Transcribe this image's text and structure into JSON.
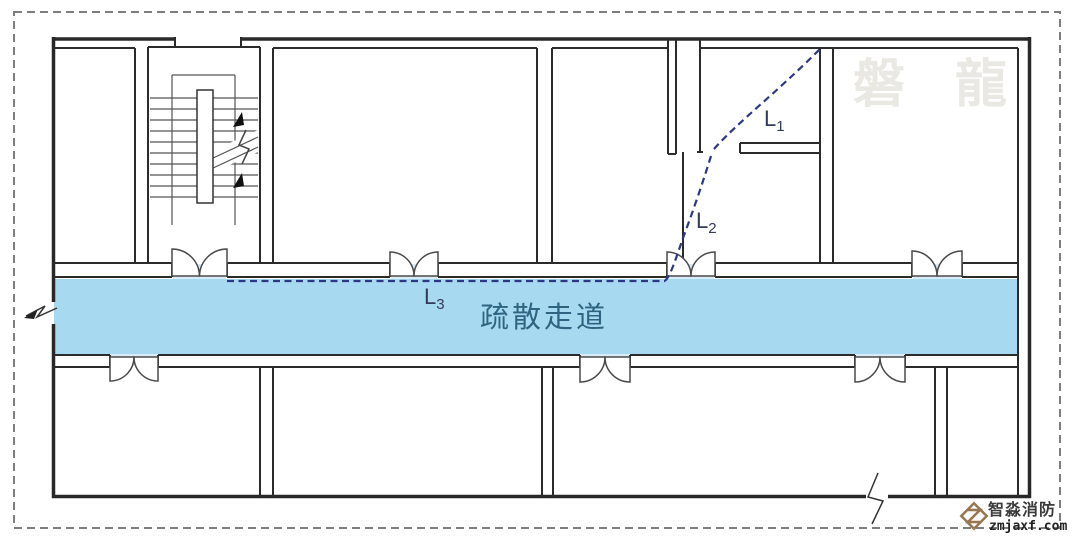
{
  "diagram": {
    "type": "evacuation-floor-plan",
    "corridor": {
      "label": "疏散走道",
      "fill_color": "#a7d9f1",
      "label_color": "#2e647f"
    },
    "path_labels": {
      "l1": {
        "base": "L",
        "sub": "1"
      },
      "l2": {
        "base": "L",
        "sub": "2"
      },
      "l3": {
        "base": "L",
        "sub": "3"
      }
    },
    "escape_path": {
      "color": "#2c3884",
      "style": "dashed"
    },
    "watermark": {
      "text": "磐 龍",
      "color": "#e9e8e3"
    },
    "logo": {
      "company": "智淼消防",
      "website": "zmjaxf.com",
      "accent_color": "#96774f"
    }
  }
}
